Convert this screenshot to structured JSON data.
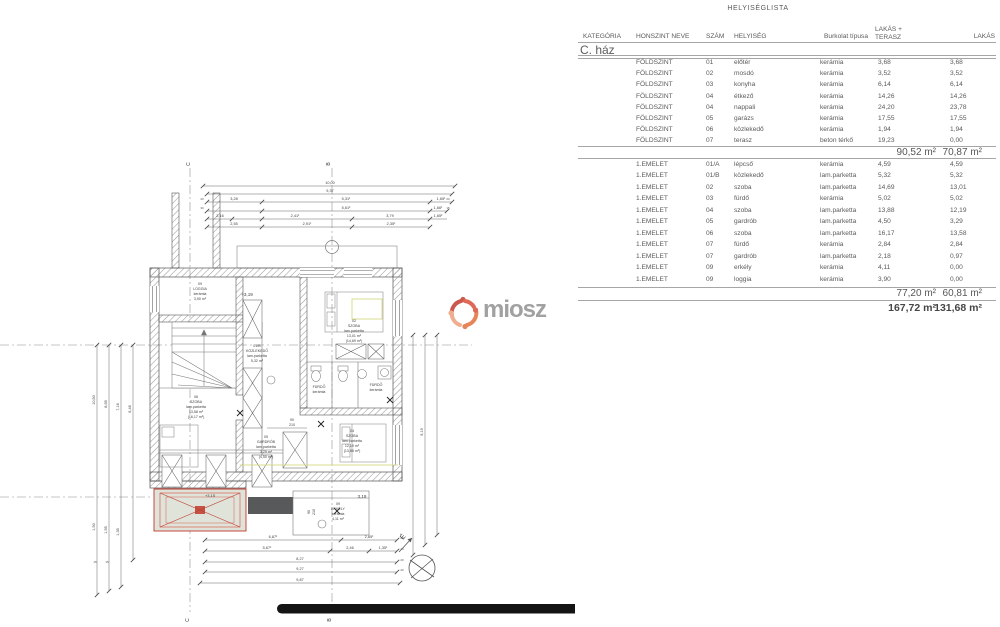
{
  "logo": {
    "text": "miosz"
  },
  "plan": {
    "grid": {
      "c": "C",
      "b": "B"
    },
    "compass_north": "É",
    "levels": {
      "l1": "+3,19",
      "l2": "+3,15",
      "l3": "3,19"
    },
    "doors": {
      "w": "90",
      "h": "210"
    },
    "ticks": {
      "t20": "20",
      "t30": "30",
      "t15": "15"
    },
    "dims_top": [
      "10,00",
      "9,37",
      "3,28",
      "5,31¹",
      "1,65¹",
      "5,61²",
      "1,66¹",
      "2,16",
      "2,41¹",
      "3,79",
      "1,65²",
      "2,55",
      "2,91¹",
      "2,35¹"
    ],
    "dims_bottom": [
      "6,87¹",
      "2,85¹",
      "5,67¹",
      "2,46",
      "1,35¹",
      "8,27",
      "9,27",
      "9,87"
    ],
    "dims_left": [
      "10,50",
      "8,65",
      "7,16",
      "6,46",
      "1,50",
      "1,55",
      "1,35"
    ],
    "dims_right": [
      "9,19"
    ],
    "rooms": {
      "loggia": {
        "num": "09",
        "name": "LOGGIA",
        "mat": "kerámia",
        "area": "3,90 m²"
      },
      "kozlekedo": {
        "num": "01/B",
        "name": "KÖZLEKEDŐ",
        "mat": "lam.parketta",
        "area": "5,32 m²"
      },
      "szoba06": {
        "num": "06",
        "name": "SZOBA",
        "mat": "lam.parketta",
        "area": "13,58 m²",
        "area2": "(16,17 m²)"
      },
      "gardrob05": {
        "num": "05",
        "name": "GARDRÓB",
        "mat": "lam.parketta",
        "area": "3,29 m²",
        "area2": "(4,50 m²)"
      },
      "szoba02": {
        "num": "02",
        "name": "SZOBA",
        "mat": "lam.parketta",
        "area": "13,01 m²",
        "area2": "(14,69 m²)"
      },
      "szoba04": {
        "num": "04",
        "name": "SZOBA",
        "mat": "lam.parketta",
        "area": "12,19 m²",
        "area2": "(13,88 m²)"
      },
      "furdo03": {
        "name": "FÜRDŐ",
        "mat": "kerámia"
      },
      "furdo07": {
        "name": "FÜRDŐ",
        "mat": "kerámia"
      },
      "erkely": {
        "num": "09",
        "name": "ERKÉLY",
        "mat": "kerámia",
        "area": "4,11 m²"
      }
    }
  },
  "table": {
    "title": "HELYISÉGLISTA",
    "headers": [
      "KATEGÓRIA",
      "HONSZINT NEVE",
      "SZÁM",
      "HELYISÉG",
      "Burkolat típusa",
      "LAKÁS + TERASZ",
      "LAKÁS"
    ],
    "category": "C. ház",
    "sections": [
      {
        "rows": [
          [
            "FÖLDSZINT",
            "01",
            "előtér",
            "kerámia",
            "3,68",
            "3,68"
          ],
          [
            "FÖLDSZINT",
            "02",
            "mosdó",
            "kerámia",
            "3,52",
            "3,52"
          ],
          [
            "FÖLDSZINT",
            "03",
            "konyha",
            "kerámia",
            "6,14",
            "6,14"
          ],
          [
            "FÖLDSZINT",
            "04",
            "étkező",
            "kerámia",
            "14,26",
            "14,26"
          ],
          [
            "FÖLDSZINT",
            "04",
            "nappali",
            "kerámia",
            "24,20",
            "23,78"
          ],
          [
            "FÖLDSZINT",
            "05",
            "garázs",
            "kerámia",
            "17,55",
            "17,55"
          ],
          [
            "FÖLDSZINT",
            "06",
            "közlekedő",
            "kerámia",
            "1,94",
            "1,94"
          ],
          [
            "FÖLDSZINT",
            "07",
            "terasz",
            "beton térkő",
            "19,23",
            "0,00"
          ]
        ],
        "subtotal_lt": "90,52 m²",
        "subtotal_l": "70,87 m²"
      },
      {
        "rows": [
          [
            "1.EMELET",
            "01/A",
            "lépcső",
            "kerámia",
            "4,59",
            "4,59"
          ],
          [
            "1.EMELET",
            "01/B",
            "közlekedő",
            "lam.parketta",
            "5,32",
            "5,32"
          ],
          [
            "1.EMELET",
            "02",
            "szoba",
            "lam.parketta",
            "14,69",
            "13,01"
          ],
          [
            "1.EMELET",
            "03",
            "fürdő",
            "kerámia",
            "5,02",
            "5,02"
          ],
          [
            "1.EMELET",
            "04",
            "szoba",
            "lam.parketta",
            "13,88",
            "12,19"
          ],
          [
            "1.EMELET",
            "05",
            "gardrób",
            "lam.parketta",
            "4,50",
            "3,29"
          ],
          [
            "1.EMELET",
            "06",
            "szoba",
            "lam.parketta",
            "16,17",
            "13,58"
          ],
          [
            "1.EMELET",
            "07",
            "fürdő",
            "kerámia",
            "2,84",
            "2,84"
          ],
          [
            "1.EMELET",
            "07",
            "gardrób",
            "lam.parketta",
            "2,18",
            "0,97"
          ],
          [
            "1.EMELET",
            "09",
            "erkély",
            "kerámia",
            "4,11",
            "0,00"
          ],
          [
            "1.EMELET",
            "09",
            "loggia",
            "kerámia",
            "3,90",
            "0,00"
          ]
        ],
        "subtotal_lt": "77,20 m²",
        "subtotal_l": "60,81 m²"
      }
    ],
    "total_lt": "167,72 m²",
    "total_l": "131,68 m²"
  }
}
